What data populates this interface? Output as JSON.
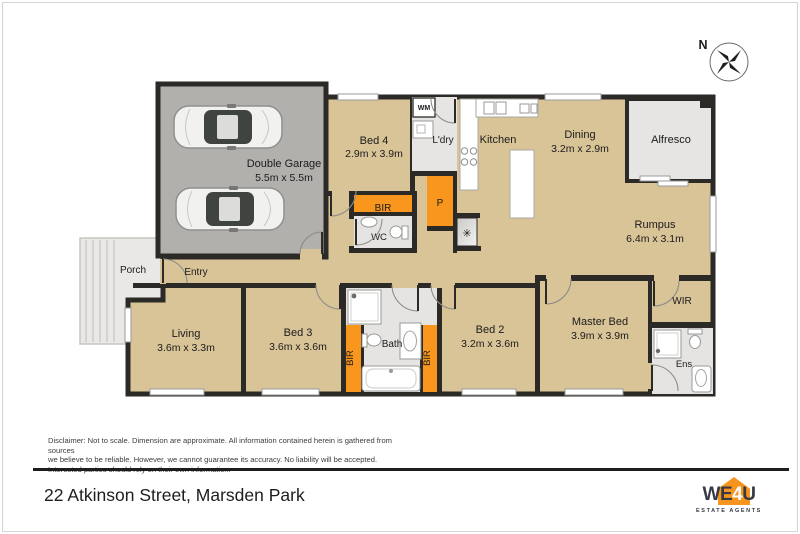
{
  "colors": {
    "floor_tan": "#d9c497",
    "garage_gray": "#b2b0ad",
    "wet_area_gray": "#e5e4e2",
    "wall": "#2b2a26",
    "wardrobe_orange": "#f8961d",
    "logo_orange": "#f7941e",
    "logo_dark": "#363a45"
  },
  "compass": {
    "label": "N"
  },
  "rooms": {
    "garage": {
      "name": "Double Garage",
      "dims": "5.5m x 5.5m"
    },
    "bed4": {
      "name": "Bed 4",
      "dims": "2.9m x 3.9m"
    },
    "wm": {
      "name": "WM"
    },
    "laundry": {
      "name": "L'dry"
    },
    "kitchen": {
      "name": "Kitchen"
    },
    "dining": {
      "name": "Dining",
      "dims": "3.2m x 2.9m"
    },
    "alfresco": {
      "name": "Alfresco"
    },
    "rumpus": {
      "name": "Rumpus",
      "dims": "6.4m x 3.1m"
    },
    "pantry": {
      "name": "P"
    },
    "fridge": {
      "symbol": "✳"
    },
    "bir_bed4": {
      "name": "BIR"
    },
    "wc": {
      "name": "WC"
    },
    "porch": {
      "name": "Porch"
    },
    "entry": {
      "name": "Entry"
    },
    "living": {
      "name": "Living",
      "dims": "3.6m x 3.3m"
    },
    "bed3": {
      "name": "Bed 3",
      "dims": "3.6m x 3.6m"
    },
    "bath": {
      "name": "Bath"
    },
    "bir_bed3": {
      "name": "BIR"
    },
    "bir_bed2": {
      "name": "BIR"
    },
    "bed2": {
      "name": "Bed 2",
      "dims": "3.2m x 3.6m"
    },
    "master": {
      "name": "Master Bed",
      "dims": "3.9m x 3.9m"
    },
    "wir": {
      "name": "WIR"
    },
    "ens": {
      "name": "Ens"
    }
  },
  "disclaimer": {
    "line1": "Disclaimer: Not to scale. Dimension are approximate. All information contained herein is gathered from sources",
    "line2": "we believe to be reliable. However, we cannot guarantee its accuracy. No liability will be accepted.",
    "line3": "Interested parties should rely on their own information."
  },
  "footer": {
    "address": "22 Atkinson Street, Marsden Park"
  },
  "logo": {
    "we": "WE",
    "four": "4",
    "u": "U",
    "tagline": "ESTATE AGENTS"
  }
}
